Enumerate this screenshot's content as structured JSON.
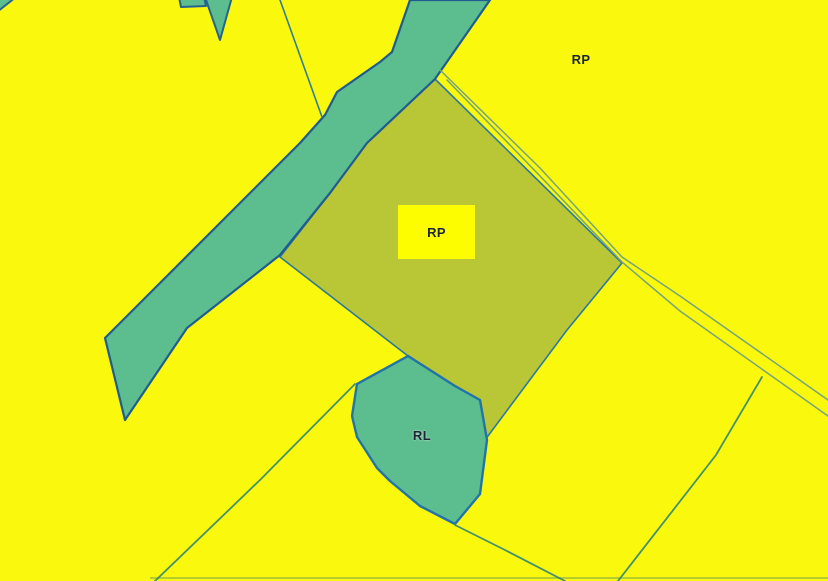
{
  "map": {
    "type": "zoning-parcel-map",
    "labels": {
      "northeast_zone": "RP",
      "center_parcel": "RP",
      "green_zone": "RL"
    },
    "colors": {
      "background_yellow": "#faf80d",
      "parcel_olive": "#b9c636",
      "green_area": "#5cbd8e",
      "corridor_outline": "#1e5c91",
      "rl_outline": "#2173ac",
      "thin_boundary_line": "#43926c",
      "road_line": "#76a47b",
      "label_text": "#1d2636",
      "label_box_fill": "#fdfd00"
    }
  }
}
